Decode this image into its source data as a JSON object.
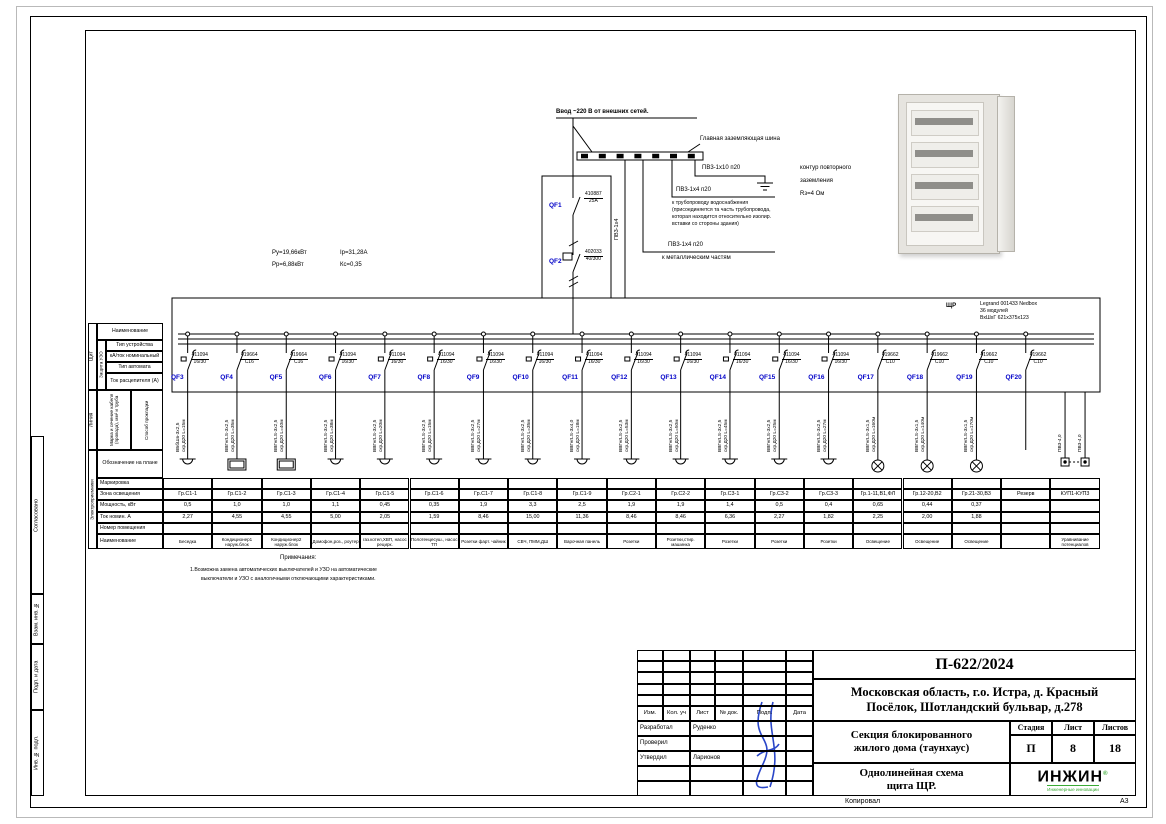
{
  "colors": {
    "accent_blue": "#0000c8",
    "signature_blue": "#2a46c8",
    "logo_green": "#3aaa35"
  },
  "incoming": {
    "feed_label": "Ввод ~220 В от внешних сетей.",
    "gzsh_label": "Главная заземляющая шина",
    "pv10_label": "ПВ3-1х10 п20",
    "kontur_line1": "контур повторного",
    "kontur_line2": "заземления",
    "kontur_line3": "Rз=4 Ом",
    "pipe_label": "ПВ3-1х4 п20",
    "pipe_line1": "к трубопроводу водоснабжения",
    "pipe_line2": "(присоединяется та часть трубопровода,",
    "pipe_line3": "которая находится относительно изолир.",
    "pipe_line4": "вставки со стороны здания)",
    "metal_label": "ПВ3-1х4 п20",
    "metal_line": "к металлическим частям",
    "pe_vertical_label": "ПВ3-1х4",
    "qf1": {
      "name": "QF1",
      "art": "410887",
      "rating": "25А"
    },
    "qf2": {
      "name": "QF2",
      "art": "402033",
      "rating": "40/300"
    }
  },
  "power_summary": {
    "pu": "Ру=19,66кВт",
    "ip": "Iр=31,28А",
    "pp": "Рр=6,88кВт",
    "kc": "Кс=0,35"
  },
  "panel": {
    "tag": "ЩР",
    "spec1": "Legrand 001433 Nedbox",
    "spec2": "36 модулей",
    "spec3": "ВхШхГ 621х375х123"
  },
  "left_header": {
    "group_shield": "Щит",
    "group_protect": "Защита УЗО",
    "group_line": "Линия",
    "group_consumers": "Электроприемники",
    "row_name": "Наименование",
    "row_device_type": "Тип устройства",
    "row_ka": "кА/ток номинальный",
    "row_breaker_type": "Тип автомата",
    "row_trip": "Ток расцепителя (А)",
    "row_cable": "Марка и сечение кабеля (провода), мм² и труба",
    "row_laying": "Способ прокладки",
    "row_plan": "Обозначение на плане",
    "row_marking": "Маркировка",
    "row_zone": "Зона освещения",
    "row_power": "Мощность, кВт",
    "row_current": "Ток номин. А",
    "row_room": "Номер помещения",
    "row_title": "Наименование"
  },
  "circuits": [
    {
      "qf": "QF3",
      "art": "411094",
      "rating": "16/30",
      "cable": "ВБбШв-3х2,5",
      "laying": "скр.Д20 L=15м",
      "symbol": "socket",
      "group": "Гр.С1-1",
      "power": "0,5",
      "current": "2,27",
      "name": "Беседка"
    },
    {
      "qf": "QF4",
      "art": "419664",
      "rating": "C16",
      "cable": "ВВГнгLS-3х2,5",
      "laying": "скр.Д20 L=35м",
      "symbol": "box",
      "group": "Гр.С1-2",
      "power": "1,0",
      "current": "4,55",
      "name": "Кондиционер1 наруж.блок"
    },
    {
      "qf": "QF5",
      "art": "419664",
      "rating": "C16",
      "cable": "ВВГнгLS-3х2,5",
      "laying": "скр.Д20 L=40м",
      "symbol": "box",
      "group": "Гр.С1-3",
      "power": "1,0",
      "current": "4,55",
      "name": "Кондиционер2 наруж.блок"
    },
    {
      "qf": "QF6",
      "art": "411094",
      "rating": "16/30",
      "cable": "ВВГнгLS-3х2,5",
      "laying": "скр.Д20 L=38м",
      "symbol": "socket",
      "group": "Гр.С1-4",
      "power": "1,1",
      "current": "5,00",
      "name": "Домофон,роз., роутер"
    },
    {
      "qf": "QF7",
      "art": "411094",
      "rating": "16/30",
      "cable": "ВВГнгLS-3х2,5",
      "laying": "скр.Д20 L=20м",
      "symbol": "socket",
      "group": "Гр.С1-5",
      "power": "0,45",
      "current": "2,05",
      "name": "газ.котел,ХВП, насос рецирк."
    },
    {
      "qf": "QF8",
      "art": "411094",
      "rating": "16/30",
      "cable": "ВВГнгLS-3х2,5",
      "laying": "скр.Д20 L=15м",
      "symbol": "socket",
      "group": "Гр.С1-6",
      "power": "0,35",
      "current": "1,59",
      "name": "Полотенцесуш., насос ТП"
    },
    {
      "qf": "QF9",
      "art": "411094",
      "rating": "16/30",
      "cable": "ВВГнгLS-3х2,5",
      "laying": "скр.Д20 L=27м",
      "symbol": "socket",
      "group": "Гр.С1-7",
      "power": "1,9",
      "current": "8,46",
      "name": "Розетки фарт. чайник"
    },
    {
      "qf": "QF10",
      "art": "411094",
      "rating": "16/30",
      "cable": "ВВГнгLS-3х2,5",
      "laying": "скр.Д20 L=35м",
      "symbol": "socket",
      "group": "Гр.С1-8",
      "power": "3,3",
      "current": "15,00",
      "name": "СВЧ, ПММ,ДШ"
    },
    {
      "qf": "QF11",
      "art": "411094",
      "rating": "16/30",
      "cable": "ВВГнгLS-3х4,0",
      "laying": "скр.Д20 L=18м",
      "symbol": "socket",
      "group": "Гр.С1-9",
      "power": "2,5",
      "current": "11,36",
      "name": "Варочная панель"
    },
    {
      "qf": "QF12",
      "art": "411094",
      "rating": "16/30",
      "cable": "ВВГнгLS-3х2,5",
      "laying": "скр.Д20 L=53м",
      "symbol": "socket",
      "group": "Гр.С2-1",
      "power": "1,9",
      "current": "8,46",
      "name": "Розетки"
    },
    {
      "qf": "QF13",
      "art": "411094",
      "rating": "16/30",
      "cable": "ВВГнгLS-3х2,5",
      "laying": "скр.Д20 L=50м",
      "symbol": "socket",
      "group": "Гр.С2-2",
      "power": "1,9",
      "current": "8,46",
      "name": "Розетки,стир. машинка"
    },
    {
      "qf": "QF14",
      "art": "411094",
      "rating": "16/30",
      "cable": "ВВГнгLS-3х2,5",
      "laying": "скр.Д20 L=45м",
      "symbol": "socket",
      "group": "Гр.С3-1",
      "power": "1,4",
      "current": "6,36",
      "name": "Розетки"
    },
    {
      "qf": "QF15",
      "art": "411094",
      "rating": "16/30",
      "cable": "ВВГнгLS-3х2,5",
      "laying": "скр.Д20 L=25м",
      "symbol": "socket",
      "group": "Гр.С3-2",
      "power": "0,5",
      "current": "2,27",
      "name": "Розетки"
    },
    {
      "qf": "QF16",
      "art": "411094",
      "rating": "16/30",
      "cable": "ВВГнгLS-3х2,5",
      "laying": "скр.Д20 L=27м",
      "symbol": "socket",
      "group": "Гр.С3-3",
      "power": "0,4",
      "current": "1,82",
      "name": "Розетки"
    },
    {
      "qf": "QF17",
      "art": "419662",
      "rating": "C10",
      "cable": "ВВГнгLS-3х1,5",
      "laying": "скр.Д20 L=160м",
      "symbol": "lamp",
      "group": "Гр.1-11,В1,ФЛ",
      "power": "0,65",
      "current": "2,25",
      "name": "Освещение"
    },
    {
      "qf": "QF18",
      "art": "419662",
      "rating": "C10",
      "cable": "ВВГнгLS-3х1,5",
      "laying": "скр.Д20 L=140м",
      "symbol": "lamp",
      "group": "Гр.12-20,В2",
      "power": "0,44",
      "current": "2,00",
      "name": "Освещение"
    },
    {
      "qf": "QF19",
      "art": "419662",
      "rating": "C10",
      "cable": "ВВГнгLS-3х1,5",
      "laying": "скр.Д20 L=170м",
      "symbol": "lamp",
      "group": "Гр.21-30,В3",
      "power": "0,37",
      "current": "1,88",
      "name": "Освещение"
    },
    {
      "qf": "QF20",
      "art": "419662",
      "rating": "C10",
      "cable": "",
      "laying": "",
      "symbol": "none",
      "group": "Резерв",
      "power": "",
      "current": "",
      "name": ""
    },
    {
      "qf": "",
      "art": "",
      "rating": "",
      "cable": "ПВ3-4,0",
      "laying": "ПВ3-4,0",
      "symbol": "kup",
      "group": "КУП1-КУП3",
      "power": "",
      "current": "",
      "name": "Уравнивание потенциалов"
    }
  ],
  "notes": {
    "title": "Примечания:",
    "line1": "1.Возможна замена автоматических выключателей и УЗО на автоматические",
    "line2": "выключатели и УЗО с аналогичными отключающими характеристиками."
  },
  "titleblock": {
    "doc": "П-622/2024",
    "address1": "Московская область, г.о. Истра, д. Красный",
    "address2": "Посёлок, Шотландский бульвар, д.278",
    "object1": "Секция блокированного",
    "object2": "жилого дома (таунхаус)",
    "drawing1": "Однолинейная схема",
    "drawing2": "щита ЩР.",
    "stage_label": "Стадия",
    "sheet_label": "Лист",
    "sheets_label": "Листов",
    "stage": "П",
    "sheet": "8",
    "sheets": "18",
    "cols": {
      "izm": "Изм.",
      "kol": "Кол. уч",
      "list": "Лист",
      "doc": "№ док.",
      "podp": "Подп.",
      "data": "Дата"
    },
    "developed_label": "Разработал",
    "developed": "Руденко",
    "checked_label": "Проверил",
    "approved_label": "Утвердил",
    "approved": "Ларионов",
    "logo": "ИНЖИН",
    "logo_r": "®",
    "logo_tagline": "Инженерные инновации",
    "copied": "Копировал",
    "format": "А3"
  },
  "side_stamps": {
    "agreed": "Согласовано",
    "vzam": "Взам. инв. №",
    "podp": "Подп. и дата",
    "inv": "Инв. № подл."
  }
}
